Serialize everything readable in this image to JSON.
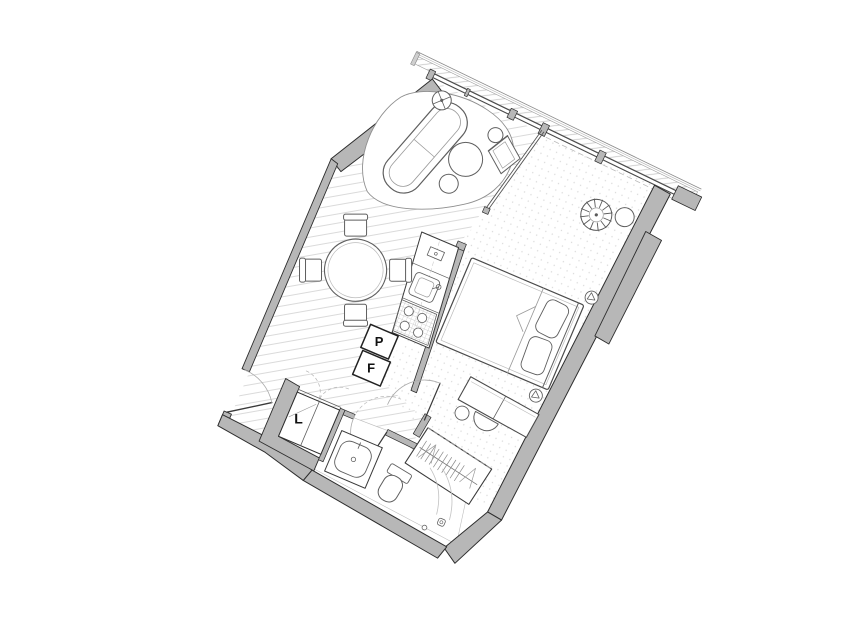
{
  "plan": {
    "type": "apartment-floor-plan",
    "labels": {
      "pantry": "P",
      "fridge": "F",
      "linen": "L"
    },
    "colors": {
      "wall_fill": "#b7b7b7",
      "wall_line": "#2d2d2d",
      "furniture_line": "#5f5f5f",
      "light_line": "#a8a8a8",
      "hatch": "#d0d0d0",
      "label": "#111111",
      "floor": "#ffffff"
    },
    "rooms": [
      {
        "name": "living-dining-area"
      },
      {
        "name": "bedroom"
      },
      {
        "name": "bathroom"
      },
      {
        "name": "entry-hall"
      },
      {
        "name": "kitchenette"
      }
    ],
    "fixtures": [
      "curved-sofa",
      "armchair",
      "coffee-tables",
      "floor-lamp",
      "dining-table-with-4-chairs",
      "kitchen-sink",
      "cooktop",
      "pantry-cabinet",
      "fridge-cabinet",
      "double-bed",
      "wall-sconces",
      "desk-with-chair",
      "plant",
      "side-table",
      "wardrobe-with-hangers",
      "linen-closet",
      "vanity-sink",
      "toilet",
      "shower",
      "entry-door",
      "bathroom-door",
      "bedroom-door",
      "window-wall",
      "balcony-edge"
    ]
  }
}
